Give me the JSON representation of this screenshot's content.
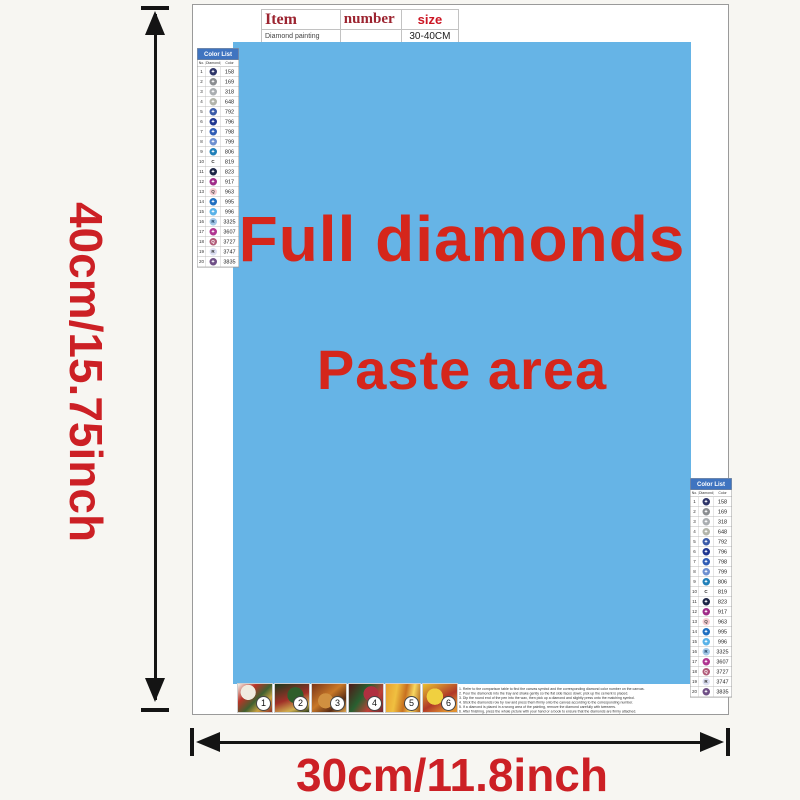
{
  "item_table": {
    "headers": [
      "Item",
      "number",
      "size"
    ],
    "row": {
      "name": "Diamond painting",
      "number": "",
      "size": "30-40CM"
    }
  },
  "paste_area": {
    "line1": "Full diamonds",
    "line2": "Paste area",
    "bg_color": "#66b4e6",
    "text_color": "#d5261b"
  },
  "color_list": {
    "title": "Color List",
    "columns": [
      "No.",
      "Diamond",
      "Color"
    ],
    "rows": [
      {
        "no": "1",
        "sym": "✦",
        "code": "158",
        "fill": "#2d3468",
        "text": "#ffffff"
      },
      {
        "no": "2",
        "sym": "✦",
        "code": "169",
        "fill": "#8a8d90",
        "text": "#ffffff"
      },
      {
        "no": "3",
        "sym": "✦",
        "code": "318",
        "fill": "#a9adb0",
        "text": "#ffffff"
      },
      {
        "no": "4",
        "sym": "✦",
        "code": "648",
        "fill": "#b2b4aa",
        "text": "#ffffff"
      },
      {
        "no": "5",
        "sym": "✦",
        "code": "792",
        "fill": "#3a5aa8",
        "text": "#ffffff"
      },
      {
        "no": "6",
        "sym": "✦",
        "code": "796",
        "fill": "#1f3690",
        "text": "#ffffff"
      },
      {
        "no": "7",
        "sym": "✦",
        "code": "798",
        "fill": "#2f5cb5",
        "text": "#ffffff"
      },
      {
        "no": "8",
        "sym": "✦",
        "code": "799",
        "fill": "#6d8fd0",
        "text": "#ffffff"
      },
      {
        "no": "9",
        "sym": "✦",
        "code": "806",
        "fill": "#1f7fb8",
        "text": "#ffffff"
      },
      {
        "no": "10",
        "sym": "C",
        "code": "819",
        "fill": "transparent",
        "text": "#222222"
      },
      {
        "no": "11",
        "sym": "✦",
        "code": "823",
        "fill": "#1c2546",
        "text": "#ffffff"
      },
      {
        "no": "12",
        "sym": "✦",
        "code": "917",
        "fill": "#a02a88",
        "text": "#ffffff"
      },
      {
        "no": "13",
        "sym": "Q",
        "code": "963",
        "fill": "#f5ccd2",
        "text": "#444444"
      },
      {
        "no": "14",
        "sym": "✦",
        "code": "995",
        "fill": "#1e6ec0",
        "text": "#ffffff"
      },
      {
        "no": "15",
        "sym": "✦",
        "code": "996",
        "fill": "#58b2e8",
        "text": "#ffffff"
      },
      {
        "no": "16",
        "sym": "R",
        "code": "3325",
        "fill": "#a2c8e8",
        "text": "#1a3a5c"
      },
      {
        "no": "17",
        "sym": "✦",
        "code": "3607",
        "fill": "#b03490",
        "text": "#ffffff"
      },
      {
        "no": "18",
        "sym": "Q",
        "code": "3727",
        "fill": "#b05a78",
        "text": "#ffffff"
      },
      {
        "no": "19",
        "sym": "R",
        "code": "3747",
        "fill": "#dcdff2",
        "text": "#333333"
      },
      {
        "no": "20",
        "sym": "✦",
        "code": "3835",
        "fill": "#6f4f86",
        "text": "#ffffff"
      }
    ]
  },
  "thumbnails": [
    {
      "label": "1"
    },
    {
      "label": "2"
    },
    {
      "label": "3"
    },
    {
      "label": "4"
    },
    {
      "label": "5"
    },
    {
      "label": "6"
    }
  ],
  "instructions": [
    "1. Refer to the comparison table to find the canvas symbol and the corresponding diamond color number on the canvas.",
    "2. Pour the diamonds into the tray and shake gently so the flat side faces down; pick up the cement is placed.",
    "3. Dip the round end of the pen into the wax, then pick up a diamond and slightly press onto the matching symbol.",
    "4. Stick the diamonds row by row and press them firmly onto the canvas according to the corresponding number.",
    "5. If a diamond is placed in a wrong area of the painting, remove the diamond carefully with tweezers.",
    "6. After finishing, press the whole picture with your hand or a book to ensure that the diamonds are firmly attached."
  ],
  "dimensions": {
    "height_label": "40cm/15.75inch",
    "width_label": "30cm/11.8inch"
  }
}
